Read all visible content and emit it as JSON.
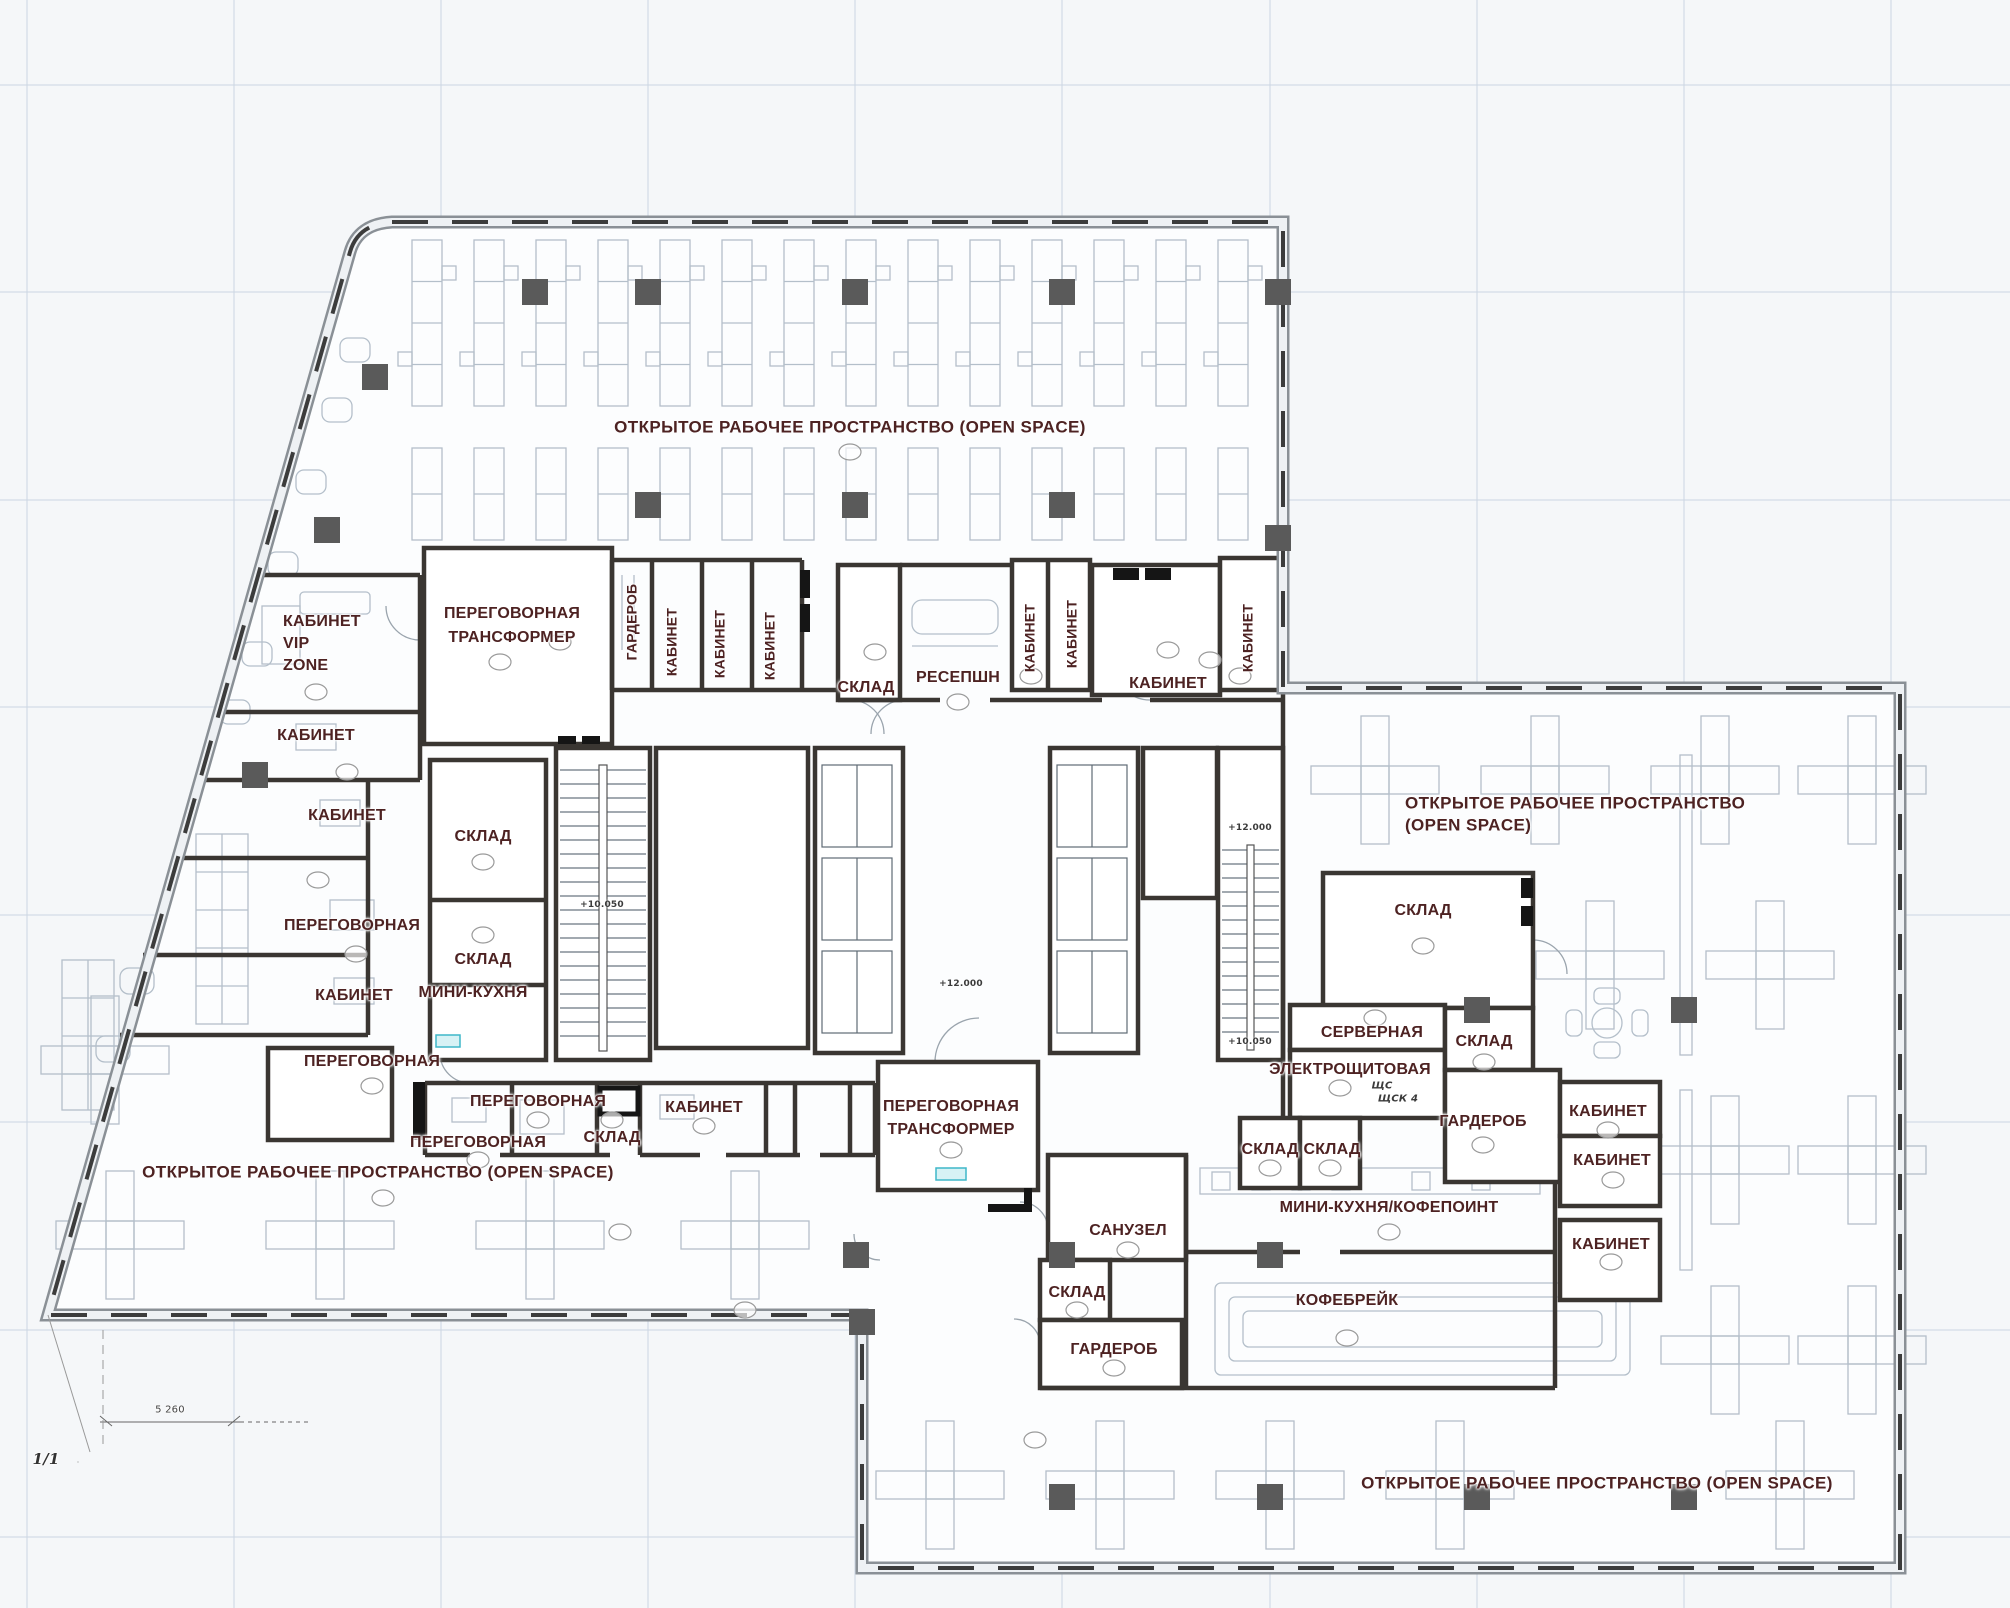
{
  "colors": {
    "label": "#4d2222",
    "wall": "#3a3632",
    "floor": "#fbfcfd",
    "furniture": "#b4bfca",
    "accent_teal": "#3fb7c9"
  },
  "open_space": {
    "top": "ОТКРЫТОЕ РАБОЧЕЕ ПРОСТРАНСТВО (OPEN SPACE)",
    "right_line1": "ОТКРЫТОЕ РАБОЧЕЕ ПРОСТРАНСТВО",
    "right_line2": "(OPEN SPACE)",
    "bottom_left": "ОТКРЫТОЕ РАБОЧЕЕ ПРОСТРАНСТВО (OPEN SPACE)",
    "bottom_right": "ОТКРЫТОЕ РАБОЧЕЕ ПРОСТРАНСТВО (OPEN SPACE)"
  },
  "rooms": {
    "meeting_transformer_1": {
      "line1": "ПЕРЕГОВОРНАЯ",
      "line2": "ТРАНСФОРМЕР"
    },
    "meeting_transformer_2": {
      "line1": "ПЕРЕГОВОРНАЯ",
      "line2": "ТРАНСФОРМЕР"
    },
    "vip_office": {
      "line1": "КАБИНЕТ",
      "line2": "VIP",
      "line3": "ZONE"
    },
    "wardrobe_mid": "ГАРДЕРОБ",
    "office_v1": "КАБИНЕТ",
    "office_v2": "КАБИНЕТ",
    "office_v3": "КАБИНЕТ",
    "storage_mid": "СКЛАД",
    "reception": "РЕСЕПШН",
    "office_v4": "КАБИНЕТ",
    "office_v5": "КАБИНЕТ",
    "office_big": "КАБИНЕТ",
    "office_v6": "КАБИНЕТ",
    "office_left_1": "КАБИНЕТ",
    "office_left_2": "КАБИНЕТ",
    "meeting_left": "ПЕРЕГОВОРНАЯ",
    "office_left_3": "КАБИНЕТ",
    "storage_left_1": "СКЛАД",
    "storage_left_2": "СКЛАД",
    "mini_kitchen": "МИНИ-КУХНЯ",
    "meeting_bl_1": "ПЕРЕГОВОРНАЯ",
    "meeting_bl_2": "ПЕРЕГОВОРНАЯ",
    "meeting_bl_3": "ПЕРЕГОВОРНАЯ",
    "storage_bl": "СКЛАД",
    "office_bl": "КАБИНЕТ",
    "storage_right_big": "СКЛАД",
    "server_room": "СЕРВЕРНАЯ",
    "electrical_room": "ЭЛЕКТРОЩИТОВАЯ",
    "storage_r1": "СКЛАД",
    "wardrobe_right": "ГАРДЕРОБ",
    "storage_r2": "СКЛАД",
    "storage_r3": "СКЛАД",
    "mini_kitchen_coffee": "МИНИ-КУХНЯ/КОФЕПОИНТ",
    "coffee_break": "КОФЕБРЕЙК",
    "office_r1": "КАБИНЕТ",
    "office_r2": "КАБИНЕТ",
    "office_r3": "КАБИНЕТ",
    "wc": "САНУЗЕЛ",
    "storage_b": "СКЛАД",
    "wardrobe_bottom": "ГАРДЕРОБ"
  },
  "levels": {
    "stair_left": "+10.050",
    "lobby": "+12.000",
    "stair_right_top": "+12.000",
    "stair_right_bottom": "+10.050"
  },
  "annotations": {
    "panel_1": "ЩС",
    "panel_2": "ЩСК 4",
    "dimension": "5 260",
    "axis": "1/1"
  }
}
